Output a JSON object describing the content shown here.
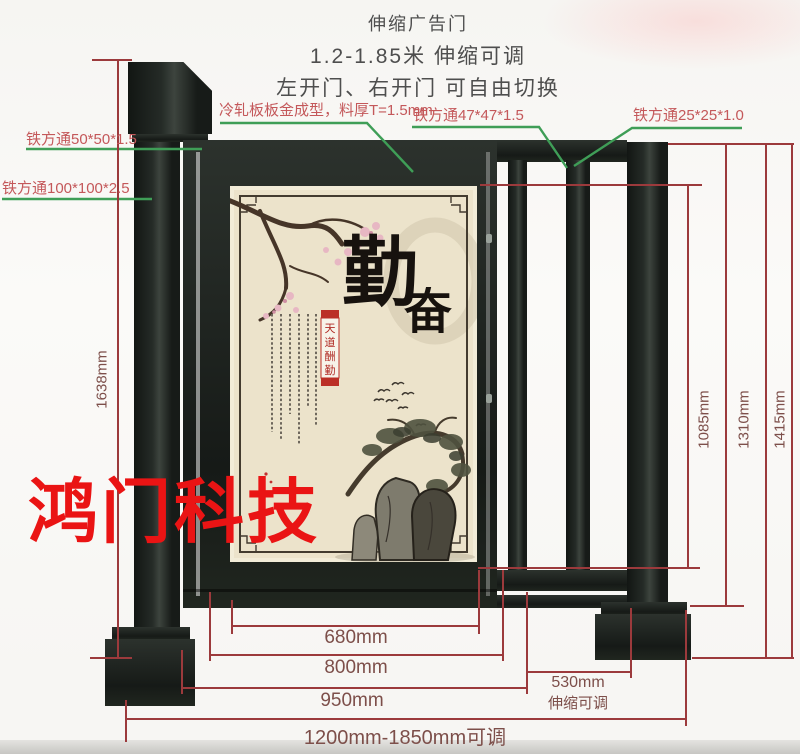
{
  "title": {
    "line1": "伸缩广告门",
    "line2": "1.2-1.85米 伸缩可调",
    "line3": "左开门、右开门 可自由切换"
  },
  "labels": {
    "square_tube_50": "铁方通50*50*1.5",
    "square_tube_100": "铁方通100*100*2.5",
    "panel_material": "冷轧板板金成型，料厚T=1.5mm",
    "square_tube_47": "铁方通47*47*1.5",
    "square_tube_25": "铁方通25*25*1.0"
  },
  "dimensions": {
    "left_height": "1638mm",
    "right_heights": [
      "1085mm",
      "1310mm",
      "1415mm"
    ],
    "bottom_680": "680mm",
    "bottom_800": "800mm",
    "bottom_950": "950mm",
    "ext_value": "530mm",
    "ext_note": "伸缩可调",
    "total_range": "1200mm-1850mm可调"
  },
  "poster": {
    "char_top": "勤",
    "char_bottom": "奋",
    "seal_chars": [
      "天",
      "道",
      "酬",
      "勤"
    ]
  },
  "watermark": "鸿门科技",
  "colors": {
    "dim_line": "#9c3a3c",
    "leader_line": "#3f9e57",
    "label_text": "#c4585a",
    "title_text": "#4e4e4e",
    "gate_dark": "#1f2420",
    "poster_bg": "#ece3cb",
    "watermark_red": "#ea1414"
  }
}
